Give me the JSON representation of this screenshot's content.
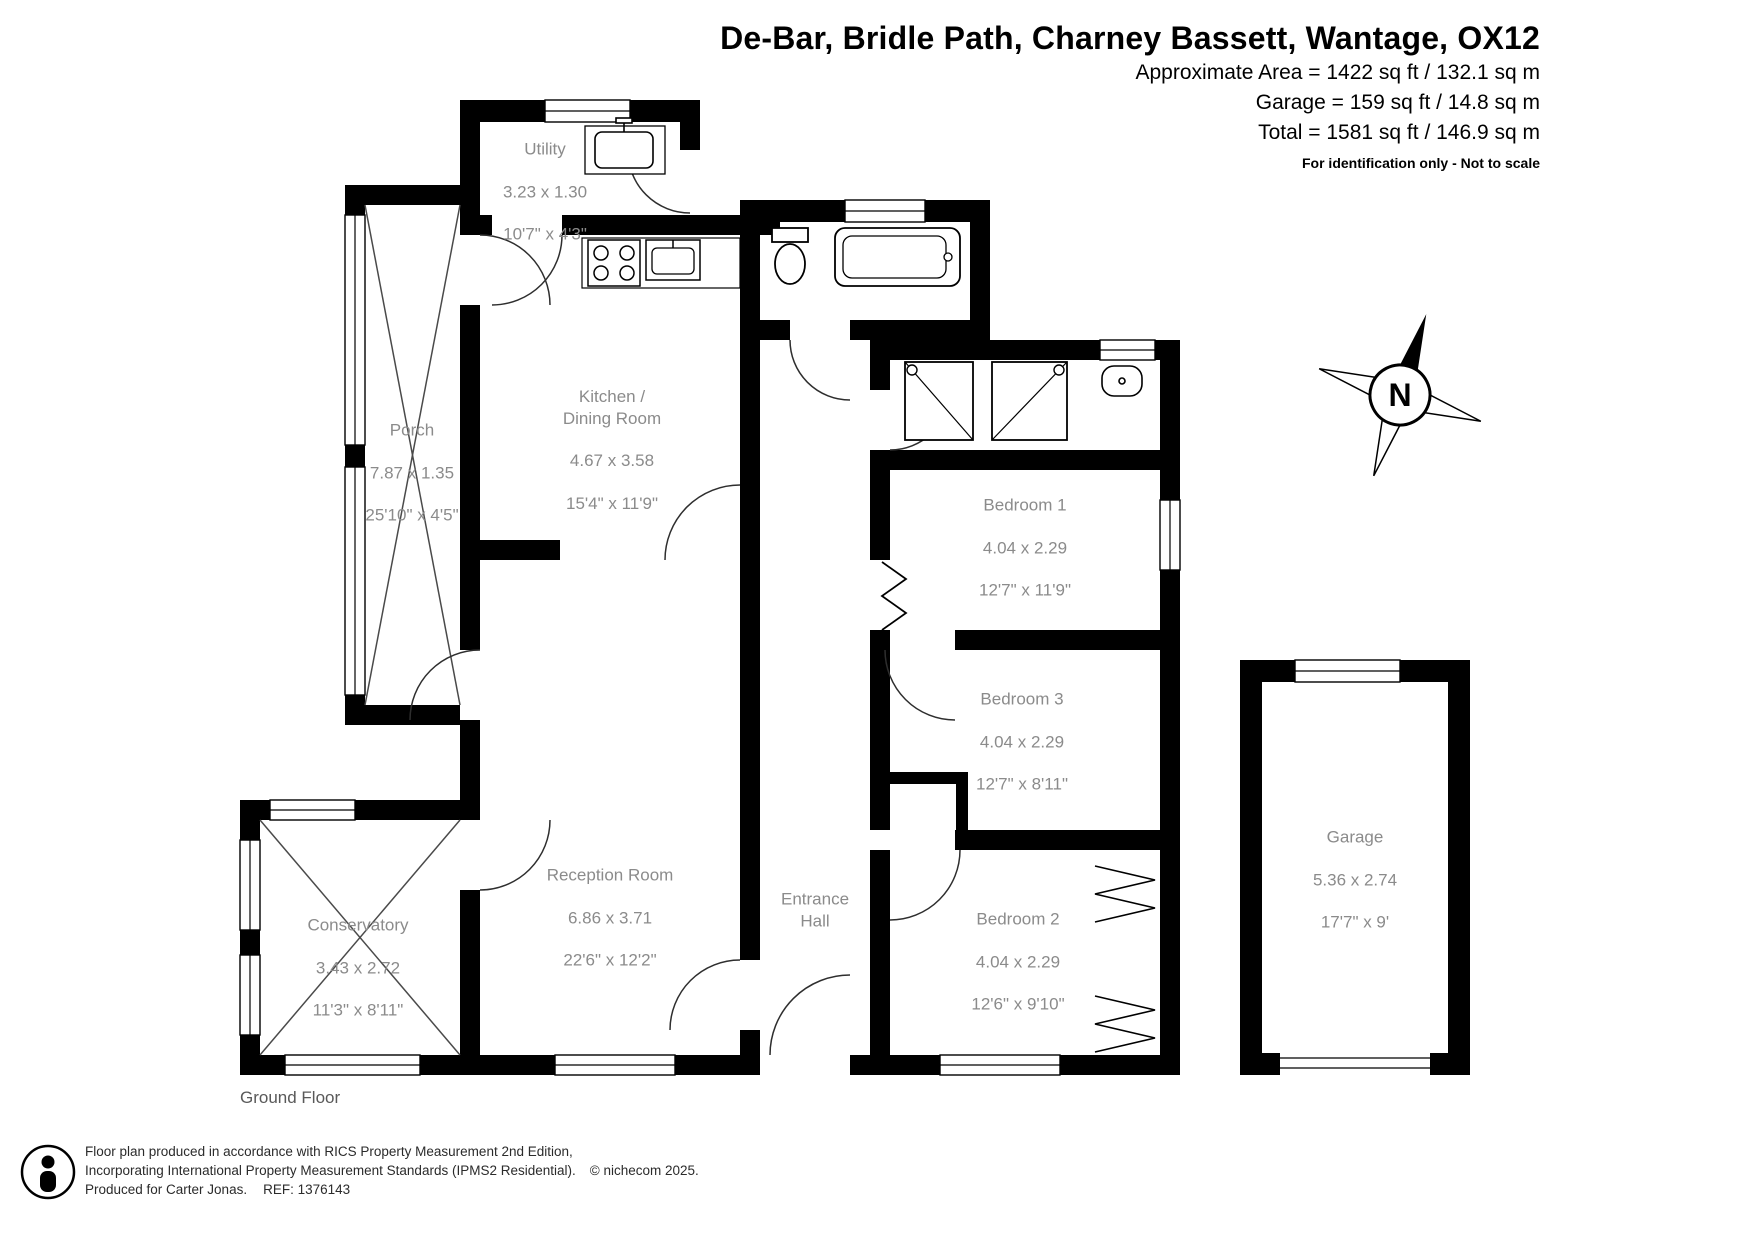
{
  "header": {
    "title": "De-Bar, Bridle Path, Charney Bassett, Wantage, OX12",
    "area_lines": [
      "Approximate Area = 1422 sq ft / 132.1 sq m",
      "Garage = 159 sq ft / 14.8 sq m",
      "Total = 1581 sq ft / 146.9 sq m"
    ],
    "disclaimer": "For identification only - Not to scale"
  },
  "rooms": [
    {
      "name": "Utility",
      "metric": "3.23 x 1.30",
      "imperial": "10'7\" x 4'3\""
    },
    {
      "name": "Kitchen /\nDining Room",
      "metric": "4.67 x 3.58",
      "imperial": "15'4\" x 11'9\""
    },
    {
      "name": "Porch",
      "metric": "7.87 x 1.35",
      "imperial": "25'10\" x 4'5\""
    },
    {
      "name": "Reception Room",
      "metric": "6.86 x 3.71",
      "imperial": "22'6\" x 12'2\""
    },
    {
      "name": "Conservatory",
      "metric": "3.43 x 2.72",
      "imperial": "11'3\" x 8'11\""
    },
    {
      "name": "Entrance\nHall",
      "metric": "",
      "imperial": ""
    },
    {
      "name": "Bedroom 1",
      "metric": "4.04 x 2.29",
      "imperial": "12'7\" x 11'9\""
    },
    {
      "name": "Bedroom 3",
      "metric": "4.04 x 2.29",
      "imperial": "12'7\" x 8'11\""
    },
    {
      "name": "Bedroom 2",
      "metric": "4.04 x 2.29",
      "imperial": "12'6\" x 9'10\""
    },
    {
      "name": "Garage",
      "metric": "5.36 x 2.74",
      "imperial": "17'7\" x 9'"
    }
  ],
  "compass": {
    "label": "N"
  },
  "floor": {
    "label": "Ground Floor"
  },
  "footer": {
    "line1": "Floor plan produced in accordance with RICS Property Measurement 2nd Edition,",
    "line2": "Incorporating International Property Measurement Standards (IPMS2 Residential).",
    "copyright": "© nichecom 2025.",
    "produced": "Produced for Carter Jonas.",
    "ref": "REF: 1376143"
  },
  "colors": {
    "wall": "#000000",
    "room_label": "#8b8b8b",
    "text": "#000000"
  }
}
